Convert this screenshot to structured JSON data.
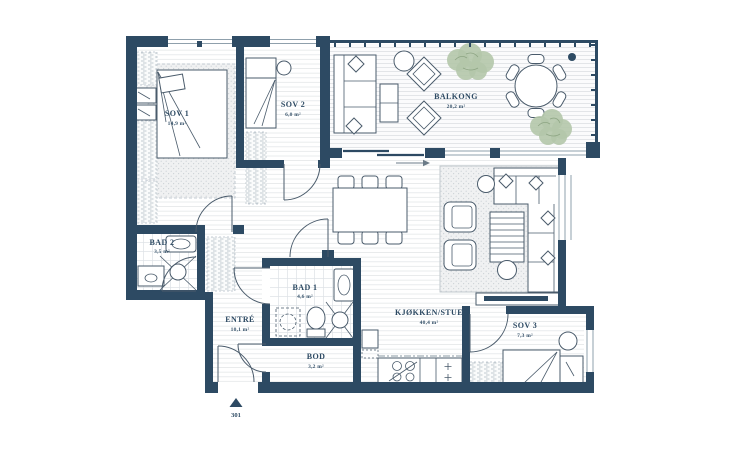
{
  "unit_number": "301",
  "colors": {
    "wall": "#2d4a63",
    "text": "#2d4a63",
    "floor_line": "#e4e7e9",
    "deck_line": "#dde0e3",
    "tile_line": "#dde2e6",
    "stipple_dot": "#ccd2d6",
    "hatch_dash": "#b4bfc7",
    "furniture_stroke": "#4a5b6b",
    "window_line": "#8fa0ac",
    "plant_fill": "#b4c6aa",
    "plant_stroke": "#839c79"
  },
  "rooms": {
    "sov1": {
      "name": "SOV 1",
      "area": "14,9 m²"
    },
    "sov2": {
      "name": "SOV 2",
      "area": "6,0 m²"
    },
    "balkong": {
      "name": "BALKONG",
      "area": "20,2 m²"
    },
    "bad2": {
      "name": "BAD 2",
      "area": "3,5 m²"
    },
    "entre": {
      "name": "ENTRÉ",
      "area": "10,1 m²"
    },
    "bad1": {
      "name": "BAD 1",
      "area": "4,6 m²"
    },
    "kjokken_stue": {
      "name": "KJØKKEN/STUE",
      "area": "40,4 m²"
    },
    "sov3": {
      "name": "SOV 3",
      "area": "7,3 m²"
    },
    "bod": {
      "name": "BOD",
      "area": "3,2 m²"
    }
  }
}
